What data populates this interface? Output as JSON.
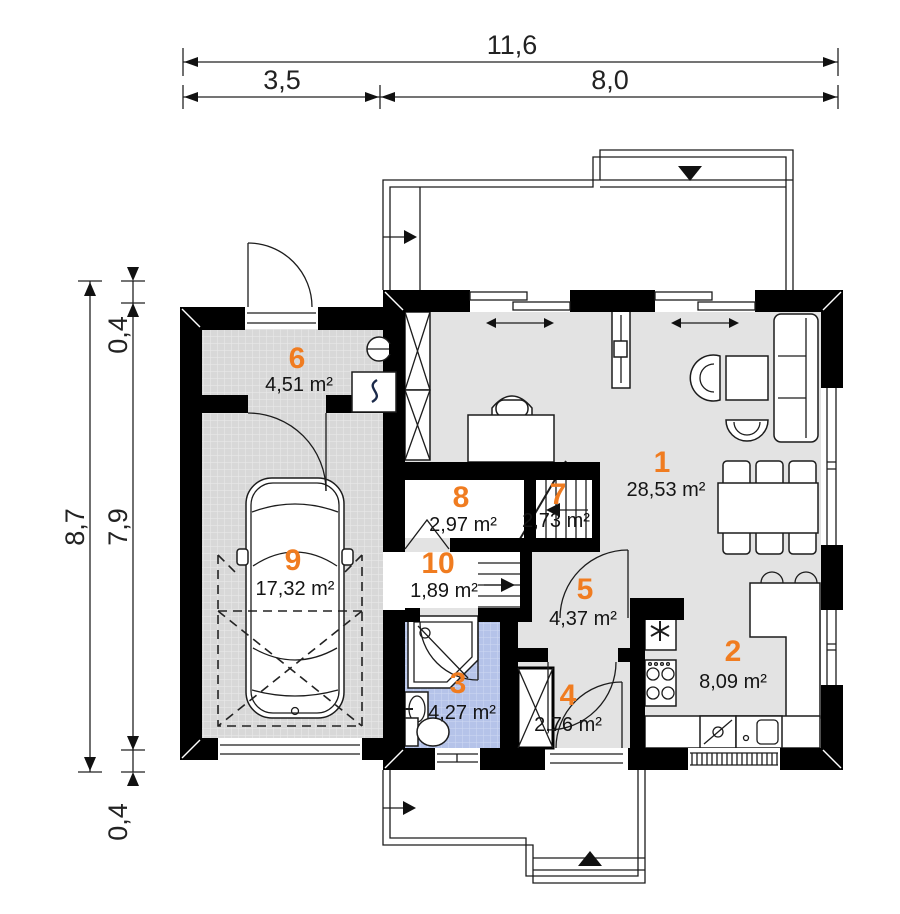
{
  "plan": {
    "type": "floor-plan",
    "dimensions": {
      "top_total": "11,6",
      "top_left": "3,5",
      "top_right": "8,0",
      "left_total": "8,7",
      "left_wall_top": "0,4",
      "left_inner": "7,9",
      "left_wall_bottom": "0,4"
    },
    "rooms": [
      {
        "number": "1",
        "area": "28,53 m²"
      },
      {
        "number": "2",
        "area": "8,09 m²"
      },
      {
        "number": "3",
        "area": "4,27 m²"
      },
      {
        "number": "4",
        "area": "2,76 m²"
      },
      {
        "number": "5",
        "area": "4,37 m²"
      },
      {
        "number": "6",
        "area": "4,51 m²"
      },
      {
        "number": "7",
        "area": "2,73 m²"
      },
      {
        "number": "8",
        "area": "2,97 m²"
      },
      {
        "number": "9",
        "area": "17,32 m²"
      },
      {
        "number": "10",
        "area": "1,89 m²"
      }
    ],
    "colors": {
      "room_number": "#f07c20",
      "wall": "#000000",
      "floor": "#e3e3e3",
      "tile_floor": "#d8d8d8",
      "bath_tile": "#b5c3e9",
      "line": "#1c1c1c"
    },
    "icons": {
      "freezer-icon": "✳",
      "boiler-icon": "ʃ",
      "vent-icon": "⊖",
      "entrance-arrow-icon": "▼"
    }
  }
}
